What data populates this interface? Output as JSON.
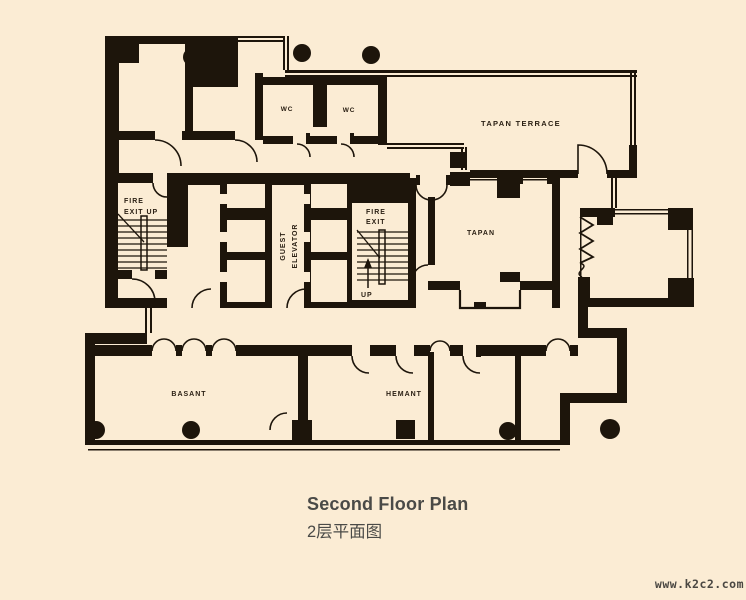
{
  "plan": {
    "labels": {
      "fire_exit_left_l1": "FIRE",
      "fire_exit_left_l2": "EXIT UP",
      "guest_elevator_l1": "GUEST",
      "guest_elevator_l2": "ELEVATOR",
      "fire_exit_right_l1": "FIRE",
      "fire_exit_right_l2": "EXIT",
      "up": "UP",
      "wc_left": "WC",
      "wc_right": "WC",
      "tapan_terrace": "TAPAN TERRACE",
      "tapan": "TAPAN",
      "basant": "BASANT",
      "hemant": "HEMANT"
    },
    "colors": {
      "background": "#fbecd4",
      "ink": "#1d150b",
      "label_text": "#2b2014"
    }
  },
  "caption": {
    "title_en": "Second Floor Plan",
    "title_zh": "2层平面图",
    "color": "#4a4a47"
  },
  "watermark": {
    "text": "www.k2c2.com",
    "color": "#4a4742"
  }
}
